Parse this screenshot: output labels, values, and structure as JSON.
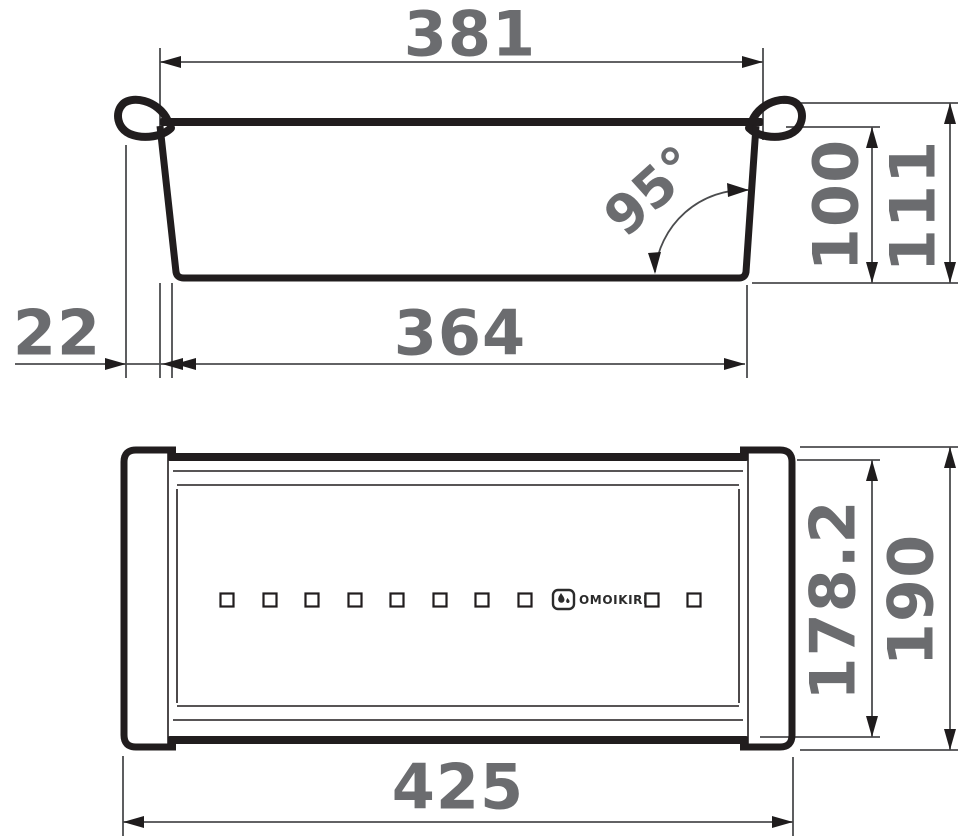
{
  "side_view": {
    "width_top": "381",
    "angle": "95°",
    "height_inner": "100",
    "height_outer": "111",
    "hook_offset": "22",
    "width_bottom": "364"
  },
  "top_view": {
    "depth_inner": "178.2",
    "depth_outer": "190",
    "length_overall": "425",
    "hole_count": 10,
    "logo_text": "OMOIKIRI"
  },
  "colors": {
    "outline": "#211d1e",
    "dimension_line": "#4b4c4e",
    "label": "#6b6c6f",
    "background": "#ffffff"
  }
}
